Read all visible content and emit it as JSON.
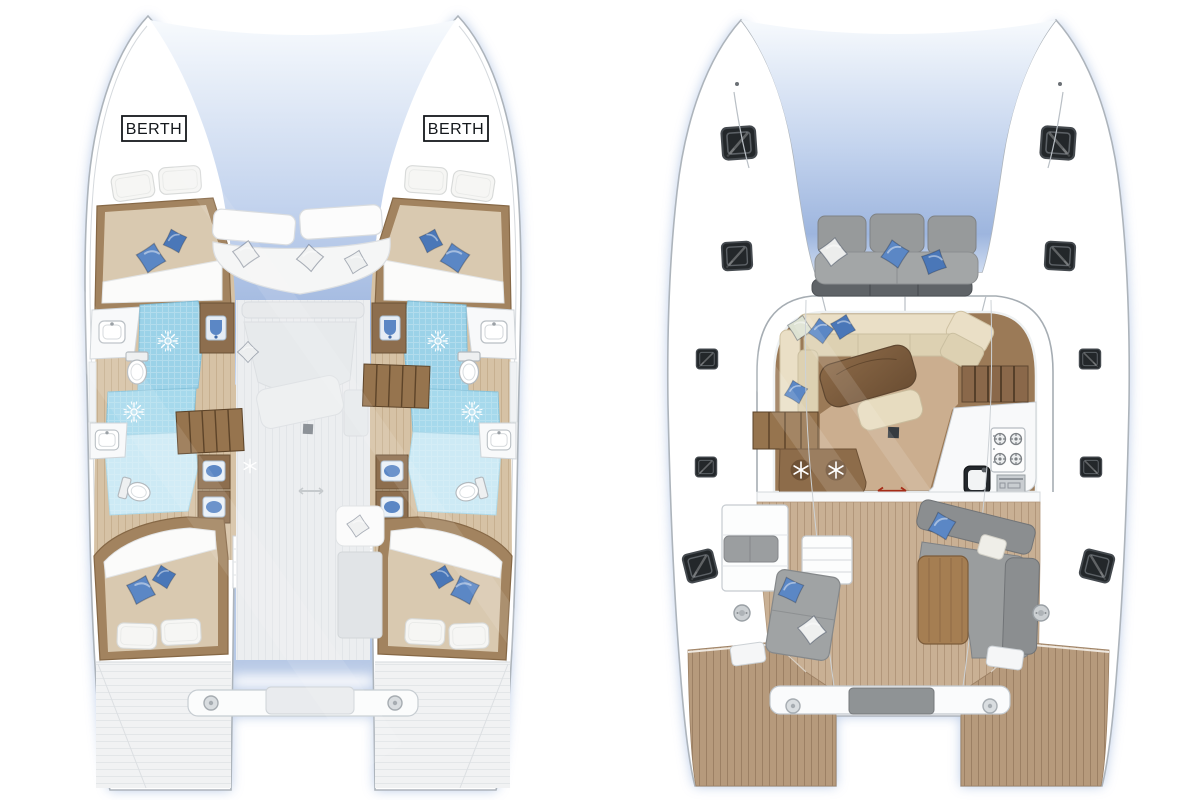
{
  "page": {
    "background": "#ffffff"
  },
  "labels": {
    "berth_port": "BERTH",
    "berth_starboard": "BERTH"
  },
  "icons": {
    "shower_sun": {
      "name": "shower-sun-icon",
      "glyph": "✳"
    },
    "snowflake": {
      "name": "snowflake-icon",
      "glyph": "❄"
    },
    "sliding_door_arrow": {
      "name": "sliding-door-arrow-icon",
      "glyph": "↔"
    },
    "stove_burner": {
      "name": "stove-burner-icon",
      "glyph": "◎"
    },
    "hatch": {
      "name": "deck-hatch-icon",
      "glyph": "▣"
    },
    "cleat": {
      "name": "deck-cleat-icon",
      "glyph": "●"
    }
  },
  "palette": {
    "background": "#ffffff",
    "hull_white": "#ffffff",
    "outline": "#adb4bb",
    "inner_line": "#d5d9dd",
    "glow_blue": "#a6bce0",
    "shadow_blue": "#a4bbe2",
    "wood_dark": "#866846",
    "wood_mid": "#a2835f",
    "wood_step": "#96744e",
    "mattress_tan": "#d9c9b0",
    "sheet_white": "#fbfbfa",
    "cream_sofa": "#eadfc6",
    "cream_seat": "#ddd1b2",
    "cushion_blue": "#5b87c5",
    "pillow_white": "#f0f1ef",
    "bath_blue": "#9bd2e8",
    "bath_floor": "#cdeaf5",
    "saloon_walkway": "#9b7a57",
    "saloon_floor": "#cbae8f",
    "teak_cockpit": "#c9b094",
    "teak_stern": "#b69a7c",
    "gray_cushion": "#9b9ea0",
    "gray_dark": "#8b8e90",
    "hatch_dark": "#23272a",
    "red_arrow": "#a62b17",
    "ghost_gray": "#e6e9eb"
  }
}
